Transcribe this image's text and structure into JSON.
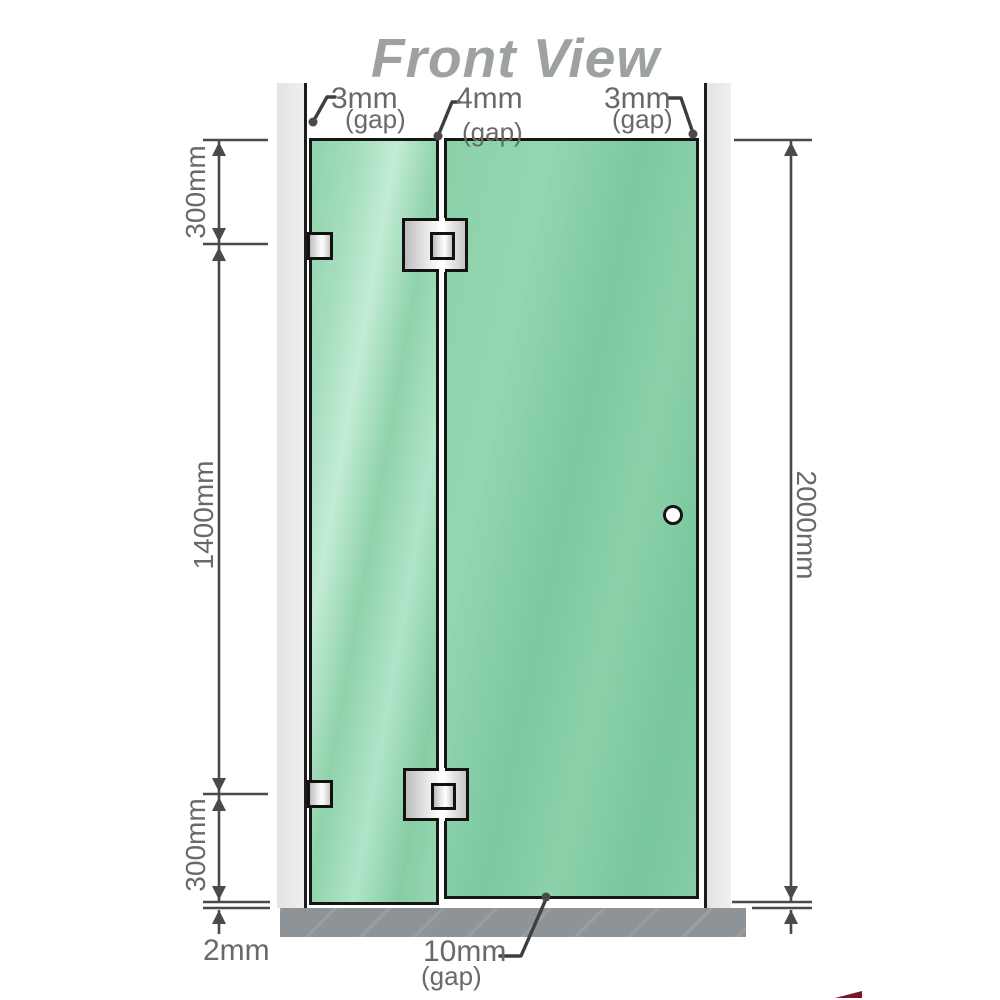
{
  "title": "Front View",
  "annotations": {
    "gap_top_left": {
      "value": "3mm",
      "suffix": "(gap)"
    },
    "gap_top_middle": {
      "value": "4mm",
      "suffix": "(gap)"
    },
    "gap_top_right": {
      "value": "3mm",
      "suffix": "(gap)"
    },
    "gap_bottom": {
      "value": "10mm",
      "suffix": "(gap)"
    },
    "floor_gap": "2mm"
  },
  "dimensions": {
    "left_top": "300mm",
    "left_middle": "1400mm",
    "left_bottom": "300mm",
    "right_overall": "2000mm"
  },
  "colors": {
    "glass": "#85cda6",
    "glass_highlight": "#c2ecd4",
    "wall": "#e9e9e9",
    "floor": "#8e9397",
    "line": "#4a4a4a",
    "label": "#696969",
    "title": "#9da1a2",
    "hardware": "#e8e8e8",
    "accent": "#7d1526"
  }
}
